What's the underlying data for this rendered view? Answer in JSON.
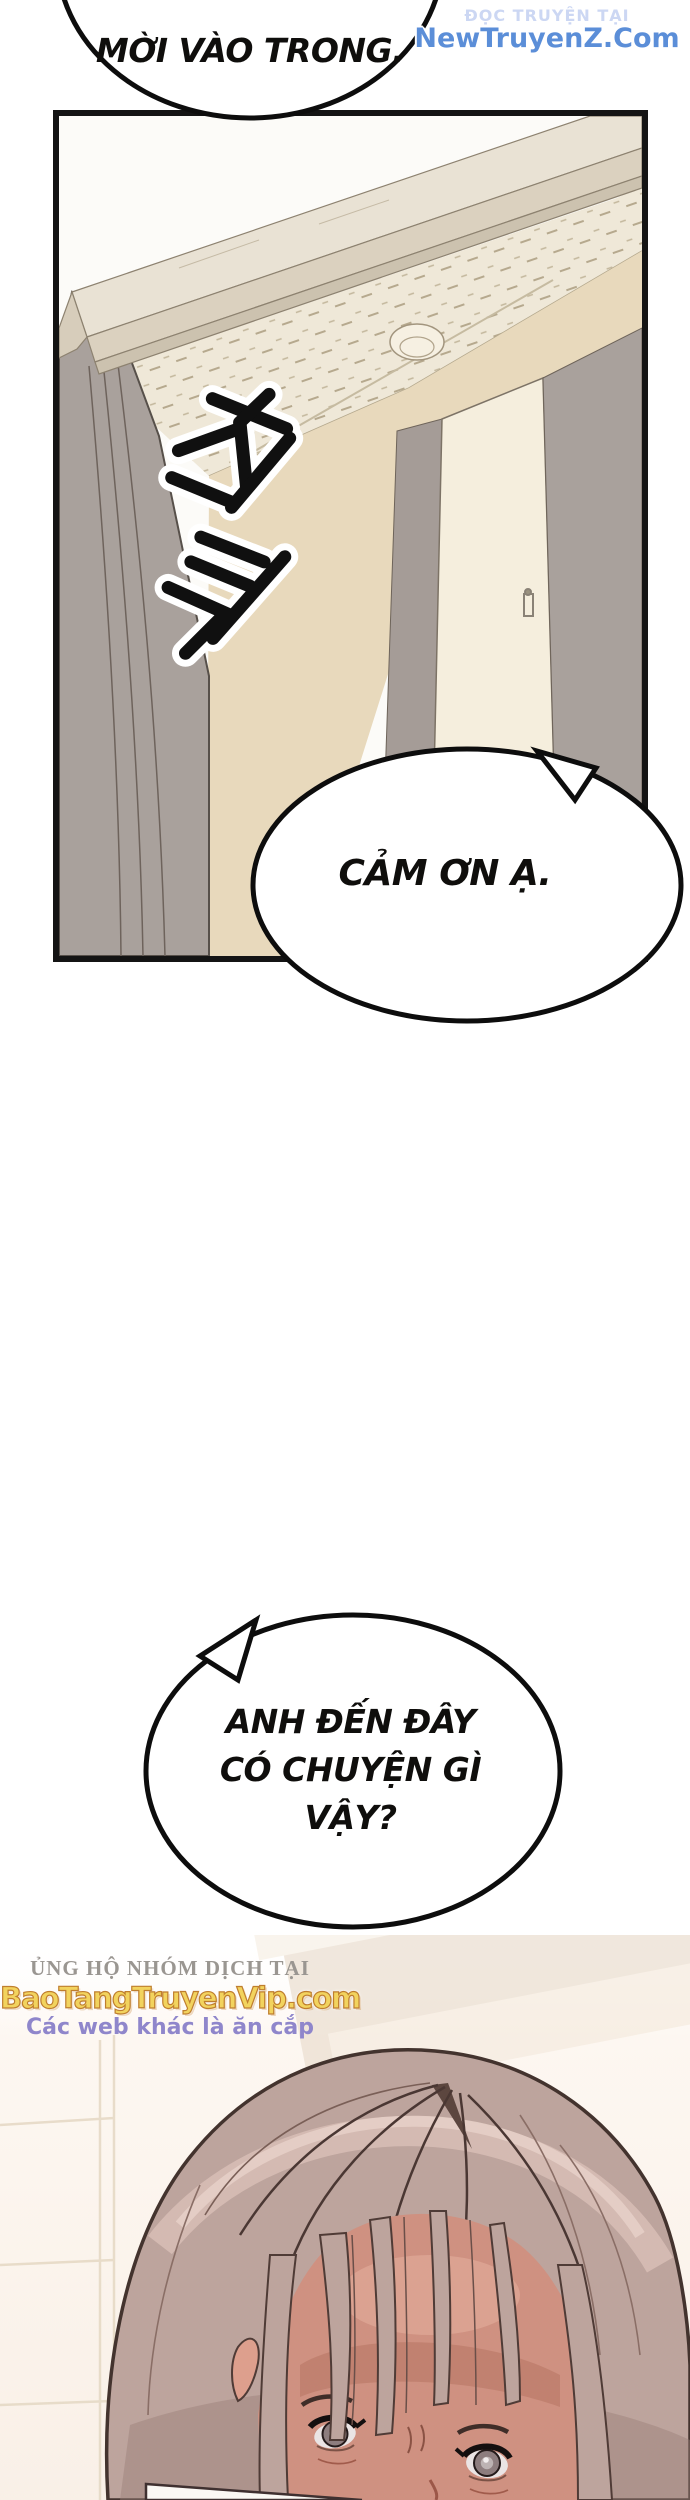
{
  "page": {
    "width": 690,
    "height": 2500,
    "background": "#ffffff"
  },
  "watermarks": {
    "top_right": {
      "line1": "ĐỌC TRUYỆN TẠI",
      "line2": "NewTruyenZ.Com"
    },
    "translator_credit": {
      "line1": "ỦNG HỘ NHÓM DỊCH TẠI",
      "line2": "BaoTangTruyenVip.com",
      "line3": "Các web khác là ăn cắp"
    }
  },
  "speech_bubbles": {
    "invite": {
      "text": "MỜI VÀO TRONG."
    },
    "thanks": {
      "text": "CẢM ƠN Ạ."
    },
    "question": {
      "lines": [
        "ANH ĐẾN ĐÂY",
        "CÓ CHUYỆN GÌ",
        "VẬY?"
      ]
    }
  },
  "sfx": {
    "text": "철컥"
  },
  "palette": {
    "ink": "#0d0d0d",
    "bubble_fill": "#ffffff",
    "frame_beige": "#e9e2d4",
    "frame_mid": "#dbd1bf",
    "frame_dark": "#ccc2af",
    "ceiling": "#efe8d8",
    "tan_wall": "#e8d9bc",
    "door_cream": "#f5eedd",
    "wall_gray": "#a9a19c",
    "jamb_gray": "#a59c97",
    "hair_base": "#bda49d",
    "hair_highlight": "#d8beb6",
    "hair_shadow": "#9a7f78",
    "hair_line": "#4a3733",
    "skin": "#cf9181",
    "skin_shadow": "#b06f5c",
    "iris": "#8d7d7e",
    "watermark_blue": "#5b8ed8",
    "watermark_pale_blue": "#ccd7f3",
    "watermark_gold": "#f2d35e",
    "watermark_gold_stroke": "#bf7e2e",
    "watermark_purple": "#8f86cb",
    "watermark_gray": "#9a9691"
  }
}
